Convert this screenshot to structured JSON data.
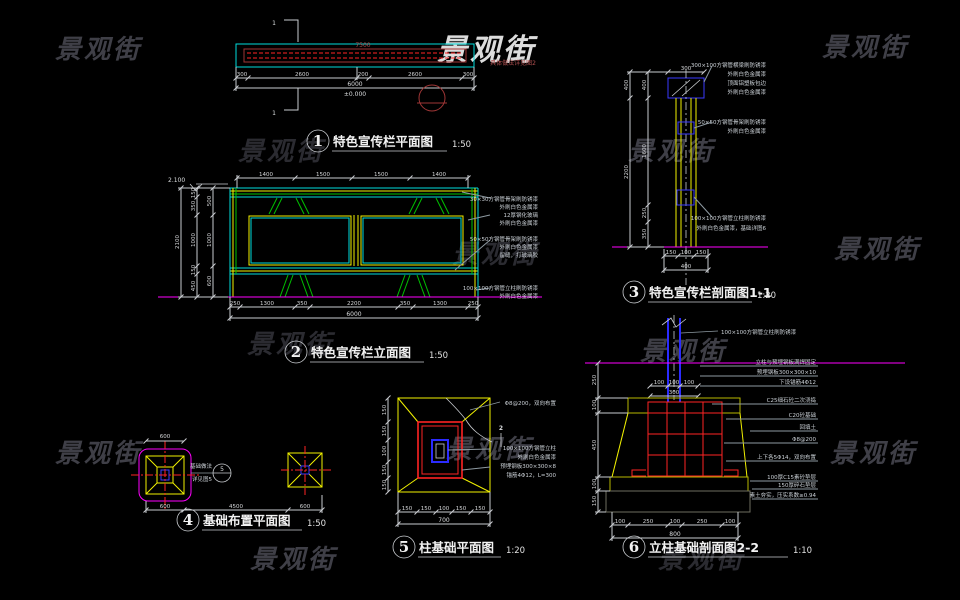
{
  "watermark": "景观街",
  "d1": {
    "title": {
      "num": "1",
      "label": "特色宣传栏平面图",
      "scale": "1:50"
    },
    "cut_mark": "1",
    "board_text": "7500",
    "side_note": "具体做法详见图2",
    "dims": [
      "300",
      "2600",
      "200",
      "2600",
      "300"
    ],
    "total": "6000",
    "datum": "±0.000"
  },
  "d2": {
    "title": {
      "num": "2",
      "label": "特色宣传栏立面图",
      "scale": "1:50"
    },
    "level": "2.100",
    "top_dims": [
      "1400",
      "1500",
      "1500",
      "1400"
    ],
    "left_dims_a": [
      "150",
      "350",
      "1000",
      "150",
      "450"
    ],
    "left_dims_b": [
      "500",
      "1000",
      "600"
    ],
    "left_total": "2100",
    "bottom_dims": [
      "250",
      "1300",
      "350",
      "2200",
      "350",
      "1300",
      "250"
    ],
    "bottom_total": "6000",
    "notes": [
      "30×30方钢管骨架刷防锈漆",
      "外刷白色金属漆",
      "12厚钢化玻璃",
      "外刷白色金属漆",
      "50×50方钢管骨架刷防锈漆",
      "外刷白色金属漆",
      "留缝，打玻璃胶",
      "100×100方钢管立柱刷防锈漆",
      "外刷白色金属漆"
    ]
  },
  "d3": {
    "title": {
      "num": "3",
      "label": "特色宣传栏剖面图1-1",
      "scale": "1:20"
    },
    "top_dim": "300",
    "left_dims_a": [
      "400",
      "1600",
      "250",
      "350"
    ],
    "left_dims_b": [
      "400",
      "2200"
    ],
    "under_dims": [
      "150",
      "100",
      "150"
    ],
    "under_total": "400",
    "notes_top": [
      "300×100方钢管横梁刷防锈漆",
      "外刷白色金属漆",
      "顶面铝塑板包边",
      "外刷白色金属漆"
    ],
    "notes_mid": [
      "50×50方钢管骨架刷防锈漆",
      "外刷白色金属漆"
    ],
    "notes_low": [
      "100×100方钢管立柱刷防锈漆",
      "外刷白色金属漆，基础详图6"
    ]
  },
  "d4": {
    "title": {
      "num": "4",
      "label": "基础布置平面图",
      "scale": "1:50"
    },
    "top_dim": "600",
    "callout_text1": "基础做法",
    "callout_text2": "详见图5",
    "callout_num": "5",
    "bottom_dims": [
      "600",
      "4500",
      "600"
    ]
  },
  "d5": {
    "title": {
      "num": "5",
      "label": "柱基础平面图",
      "scale": "1:20"
    },
    "mesh_note": "Φ8@200，双向布置",
    "cut_num": "2",
    "notes": [
      "100×100方钢管立柱",
      "外刷白色金属漆",
      "预埋钢板300×300×8",
      "锚筋4Φ12，L=300"
    ],
    "bottom_dims": [
      "150",
      "150",
      "100",
      "150",
      "150"
    ],
    "bottom_total": "700",
    "left_dims": [
      "150",
      "150",
      "100",
      "150",
      "150"
    ]
  },
  "d6": {
    "title": {
      "num": "6",
      "label": "立柱基础剖面图2-2",
      "scale": "1:10"
    },
    "post_note": "100×100方钢管立柱刷防锈漆",
    "plate_dims": [
      "100",
      "100",
      "100"
    ],
    "plate_total": "300",
    "left_dims": [
      "250",
      "100",
      "450",
      "100",
      "150"
    ],
    "bottom_dims": [
      "100",
      "250",
      "100",
      "250",
      "100"
    ],
    "bottom_total": "800",
    "notes": [
      "立柱与预埋钢板满焊固定",
      "预埋钢板300×300×10",
      "下设锚筋4Φ12",
      "C25细石砼二次浇捣",
      "C20砼基础",
      "回填土",
      "Φ8@200",
      "上下各5Φ14，双向布置",
      "100厚C15素砼垫层",
      "150厚碎石垫层",
      "素土夯实，压实系数≥0.94"
    ]
  }
}
